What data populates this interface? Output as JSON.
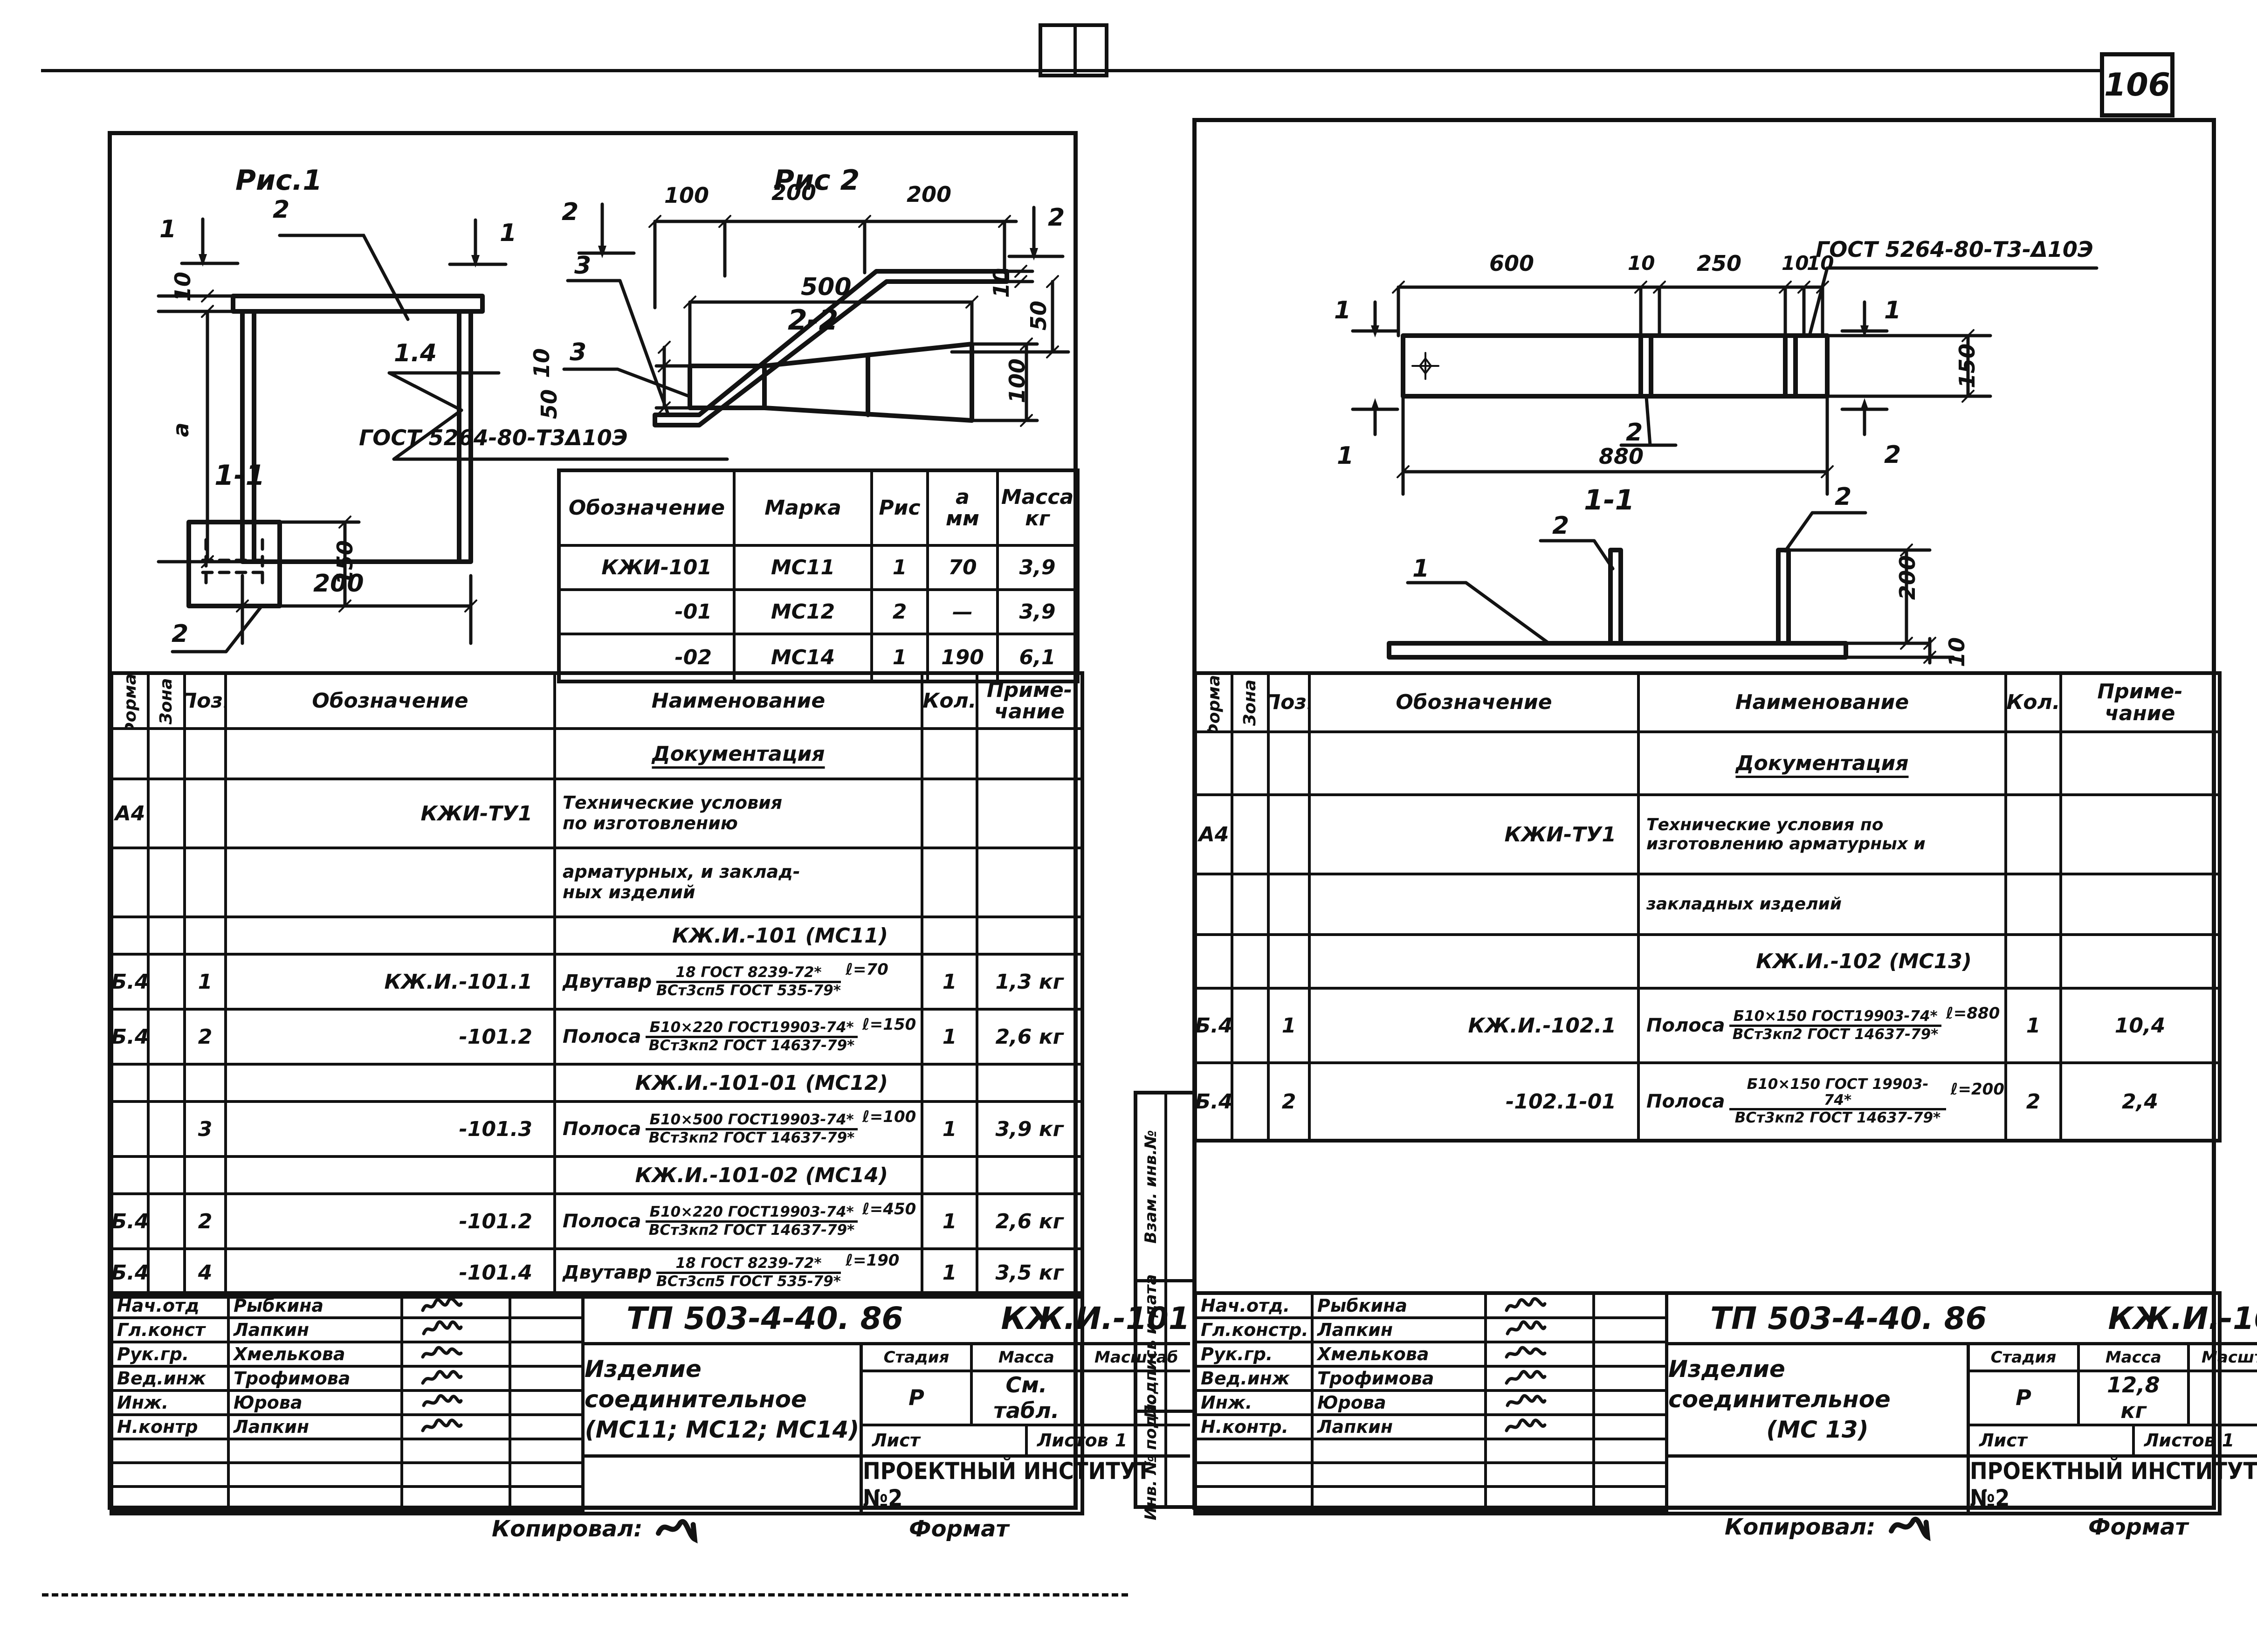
{
  "page": {
    "number": "106"
  },
  "left": {
    "fig1": {
      "title": "Рис.1",
      "callout_top": "2",
      "section_left": "1",
      "section_right": "1",
      "dim_thickness": "10",
      "dim_height": "a",
      "dim_width": "200",
      "weld_ref": "1.4",
      "weld_gost": "ГОСТ 5264-80-Т3Δ10Э",
      "section_title": "1-1",
      "dim_plate": "150",
      "callout_bottom": "2"
    },
    "fig2": {
      "title": "Рис 2",
      "dim_seg1": "100",
      "dim_seg2": "200",
      "dim_seg3": "200",
      "section_left": "2",
      "section_right": "2",
      "callout_upper": "3",
      "callout_lower": "3",
      "dim_t_right": "10",
      "dim_h_right": "50",
      "dim_total": "500",
      "section_title": "2-2",
      "dim_t_left": "10",
      "dim_h_left": "50",
      "dim_end": "100"
    },
    "parts": {
      "h_oboz": "Обозначение",
      "h_marka": "Марка",
      "h_ris": "Рис",
      "h_a": "a",
      "h_mm": "мм",
      "h_massa": "Масса",
      "h_kg": "кг",
      "rows": [
        {
          "oboz": "КЖИ-101",
          "marka": "МС11",
          "ris": "1",
          "a": "70",
          "massa": "3,9"
        },
        {
          "oboz": "-01",
          "marka": "МС12",
          "ris": "2",
          "a": "—",
          "massa": "3,9"
        },
        {
          "oboz": "-02",
          "marka": "МС14",
          "ris": "1",
          "a": "190",
          "massa": "6,1"
        }
      ]
    },
    "spec": {
      "h_format": "Формат",
      "h_zona": "Зона",
      "h_poz": "Поз.",
      "h_oboz": "Обозначение",
      "h_name": "Наименование",
      "h_qty": "Кол.",
      "h_note1": "Приме-",
      "h_note2": "чание",
      "doc_header": "Документация",
      "tu_format": "А4",
      "tu_oboz": "КЖИ-ТУ1",
      "tu_line1": "Технические условия",
      "tu_line2": "по изготовлению",
      "tu_line3": "арматурных, и заклад-",
      "tu_line4": "ных изделий",
      "group1": "КЖ.И.-101 (МС11)",
      "group2": "КЖ.И.-101-01 (МС12)",
      "group3": "КЖ.И.-101-02 (МС14)",
      "rows": [
        {
          "format": "Б.4",
          "poz": "1",
          "oboz": "КЖ.И.-101.1",
          "prefix": "Двутавр",
          "num": "18 ГОСТ 8239-72*",
          "den": "ВСт3сп5 ГОСТ 535-79*",
          "len": "ℓ=70",
          "qty": "1",
          "note": "1,3 кг"
        },
        {
          "format": "Б.4",
          "poz": "2",
          "oboz": "-101.2",
          "prefix": "Полоса",
          "num": "Б10×220 ГОСТ19903-74*",
          "den": "ВСт3кп2 ГОСТ 14637-79*",
          "len": "ℓ=150",
          "qty": "1",
          "note": "2,6 кг"
        },
        {
          "format": "",
          "poz": "3",
          "oboz": "-101.3",
          "prefix": "Полоса",
          "num": "Б10×500 ГОСТ19903-74*",
          "den": "ВСт3кп2 ГОСТ 14637-79*",
          "len": "ℓ=100",
          "qty": "1",
          "note": "3,9 кг"
        },
        {
          "format": "Б.4",
          "poz": "2",
          "oboz": "-101.2",
          "prefix": "Полоса",
          "num": "Б10×220 ГОСТ19903-74*",
          "den": "ВСт3кп2 ГОСТ 14637-79*",
          "len": "ℓ=450",
          "qty": "1",
          "note": "2,6 кг"
        },
        {
          "format": "Б.4",
          "poz": "4",
          "oboz": "-101.4",
          "prefix": "Двутавр",
          "num": "18 ГОСТ 8239-72*",
          "den": "ВСт3сп5 ГОСТ 535-79*",
          "len": "ℓ=190",
          "qty": "1",
          "note": "3,5 кг"
        }
      ]
    },
    "tb": {
      "roles": [
        {
          "role": "Нач.отд",
          "name": "Рыбкина"
        },
        {
          "role": "Гл.конст",
          "name": "Лапкин"
        },
        {
          "role": "Рук.гр.",
          "name": "Хмелькова"
        },
        {
          "role": "Вед.инж",
          "name": "Трофимова"
        },
        {
          "role": "Инж.",
          "name": "Юрова"
        },
        {
          "role": "Н.контр",
          "name": "Лапкин"
        }
      ],
      "doc": "ТП 503-4-40. 86",
      "code": "КЖ.И.-101",
      "title1": "Изделие соединительное",
      "title2": "(МС11; МС12; МС14)",
      "h_stage": "Стадия",
      "h_mass": "Масса",
      "h_scale": "Масштаб",
      "stage": "Р",
      "mass1": "См.",
      "mass2": "табл.",
      "h_sheet": "Лист",
      "h_sheets": "Листов",
      "sheets": "1",
      "org": "ПРОЕКТНЫЙ ИНСТИТУТ №2"
    },
    "footer": {
      "copied": "Копировал:",
      "format": "Формат"
    }
  },
  "right": {
    "plan": {
      "gost": "ГОСТ 5264-80-Т3-Δ10Э",
      "dim_seg1": "600",
      "dim_seg2": "10",
      "dim_seg3": "250",
      "dim_seg4": "10",
      "dim_seg5": "10",
      "dim_total": "880",
      "dim_height": "150",
      "section_left_top": "1",
      "section_left_bottom": "1",
      "flag_right_top": "1",
      "flag_right_bottom": "2",
      "callout_mid": "2"
    },
    "section": {
      "title": "1-1",
      "label_plate": "1",
      "label_rib1": "2",
      "label_rib2": "2",
      "dim_rib": "200",
      "dim_plate": "10"
    },
    "spec": {
      "h_format": "Формат",
      "h_zona": "Зона",
      "h_poz": "Поз.",
      "h_oboz": "Обозначение",
      "h_name": "Наименование",
      "h_qty": "Кол.",
      "h_note1": "Приме-",
      "h_note2": "чание",
      "doc_header": "Документация",
      "tu_format": "А4",
      "tu_oboz": "КЖИ-ТУ1",
      "tu_line1": "Технические условия по",
      "tu_line2": "изготовлению арматурных и",
      "tu_line3": "закладных изделий",
      "group1": "КЖ.И.-102 (МС13)",
      "rows": [
        {
          "format": "Б.4",
          "poz": "1",
          "oboz": "КЖ.И.-102.1",
          "prefix": "Полоса",
          "num": "Б10×150 ГОСТ19903-74*",
          "den": "ВСт3кп2 ГОСТ 14637-79*",
          "len": "ℓ=880",
          "qty": "1",
          "note": "10,4"
        },
        {
          "format": "Б.4",
          "poz": "2",
          "oboz": "-102.1-01",
          "prefix": "Полоса",
          "num": "Б10×150 ГОСТ 19903-74*",
          "den": "ВСт3кп2 ГОСТ 14637-79*",
          "len": "ℓ=200",
          "qty": "2",
          "note": "2,4"
        }
      ]
    },
    "tb": {
      "roles": [
        {
          "role": "Нач.отд.",
          "name": "Рыбкина"
        },
        {
          "role": "Гл.констр.",
          "name": "Лапкин"
        },
        {
          "role": "Рук.гр.",
          "name": "Хмелькова"
        },
        {
          "role": "Вед.инж",
          "name": "Трофимова"
        },
        {
          "role": "Инж.",
          "name": "Юрова"
        },
        {
          "role": "Н.контр.",
          "name": "Лапкин"
        }
      ],
      "doc": "ТП 503-4-40. 86",
      "code": "КЖ.И.-102",
      "title1": "Изделие соединительное",
      "title2": "(МС 13)",
      "h_stage": "Стадия",
      "h_mass": "Масса",
      "h_scale": "Масштаб",
      "stage": "Р",
      "mass1": "12,8",
      "mass2": "кг",
      "h_sheet": "Лист",
      "h_sheets": "Листов",
      "sheets": "1",
      "org": "ПРОЕКТНЫЙ ИНСТИТУТ №2"
    },
    "strip": {
      "top": "Взам. инв.№",
      "mid": "Подпись и дата",
      "bottom": "Инв. № подл."
    },
    "footer": {
      "copied": "Копировал:",
      "format": "Формат"
    }
  }
}
